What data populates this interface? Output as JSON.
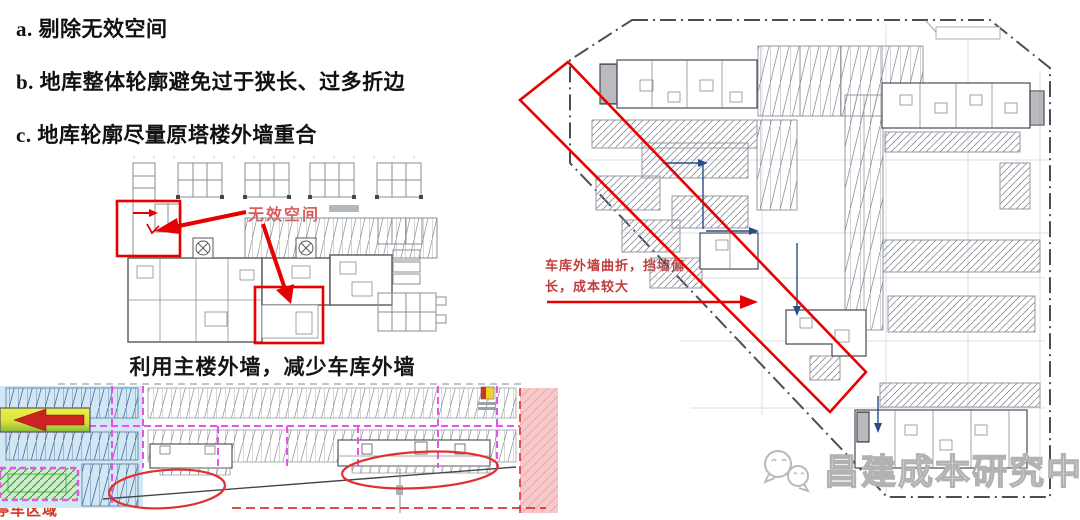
{
  "bullets": {
    "a": "a. 剔除无效空间",
    "b": "b. 地库整体轮廓避免过于狭长、过多折边",
    "c": "c. 地库轮廓尽量原塔楼外墙重合"
  },
  "mid_plan": {
    "invalid_space_label": "无效空间",
    "caption": "利用主楼外墙，减少车库外墙"
  },
  "bottom_plan": {
    "area_label": "停车区域"
  },
  "right_plan": {
    "boundary_label": "用地红线",
    "note_line1": "车库外墙曲折，挡墙偏",
    "note_line2": "长，成本较大"
  },
  "watermark": {
    "text": "昌建成本研究中心",
    "icon": "chat-bubbles-icon"
  },
  "colors": {
    "annotation_red": "#e60000",
    "note_red": "#c23b3b",
    "label_red": "#dd5a5a",
    "magenta_dashed": "#e653e6",
    "light_blue_fill": "#d2e7f4",
    "green_fill": "#cdeccb",
    "pink_fill": "#f6caca",
    "blue_arrow": "#2a4d86",
    "watermark_gray": "#b2b2b2"
  }
}
